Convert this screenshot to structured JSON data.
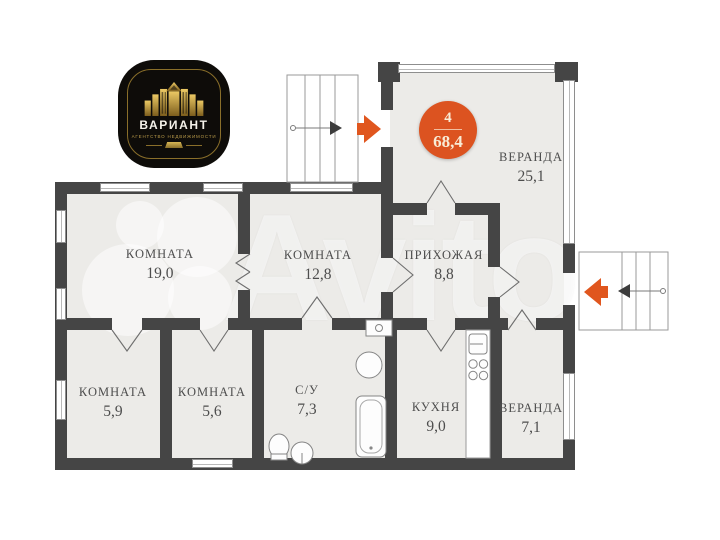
{
  "logo": {
    "brand": "ВАРИАНТ",
    "subtitle": "АГЕНТСТВО НЕДВИЖИМОСТИ"
  },
  "badge": {
    "floor_number": "4",
    "total_area": "68,4"
  },
  "watermark": {
    "text": "Avito"
  },
  "rooms": [
    {
      "id": "room-19",
      "name": "КОМНАТА",
      "area": "19,0"
    },
    {
      "id": "room-12-8",
      "name": "КОМНАТА",
      "area": "12,8"
    },
    {
      "id": "hallway",
      "name": "ПРИХОЖАЯ",
      "area": "8,8"
    },
    {
      "id": "veranda-25",
      "name": "ВЕРАНДА",
      "area": "25,1"
    },
    {
      "id": "room-5-9",
      "name": "КОМНАТА",
      "area": "5,9"
    },
    {
      "id": "room-5-6",
      "name": "КОМНАТА",
      "area": "5,6"
    },
    {
      "id": "bathroom",
      "name": "С/У",
      "area": "7,3"
    },
    {
      "id": "kitchen",
      "name": "КУХНЯ",
      "area": "9,0"
    },
    {
      "id": "veranda-7",
      "name": "ВЕРАНДА",
      "area": "7,1"
    }
  ],
  "colors": {
    "wall": "#454545",
    "floor": "#ECEBE8",
    "accent_orange": "#DC5320",
    "logo_gold": "#C9A14B",
    "label_text": "#4D4D4D"
  }
}
